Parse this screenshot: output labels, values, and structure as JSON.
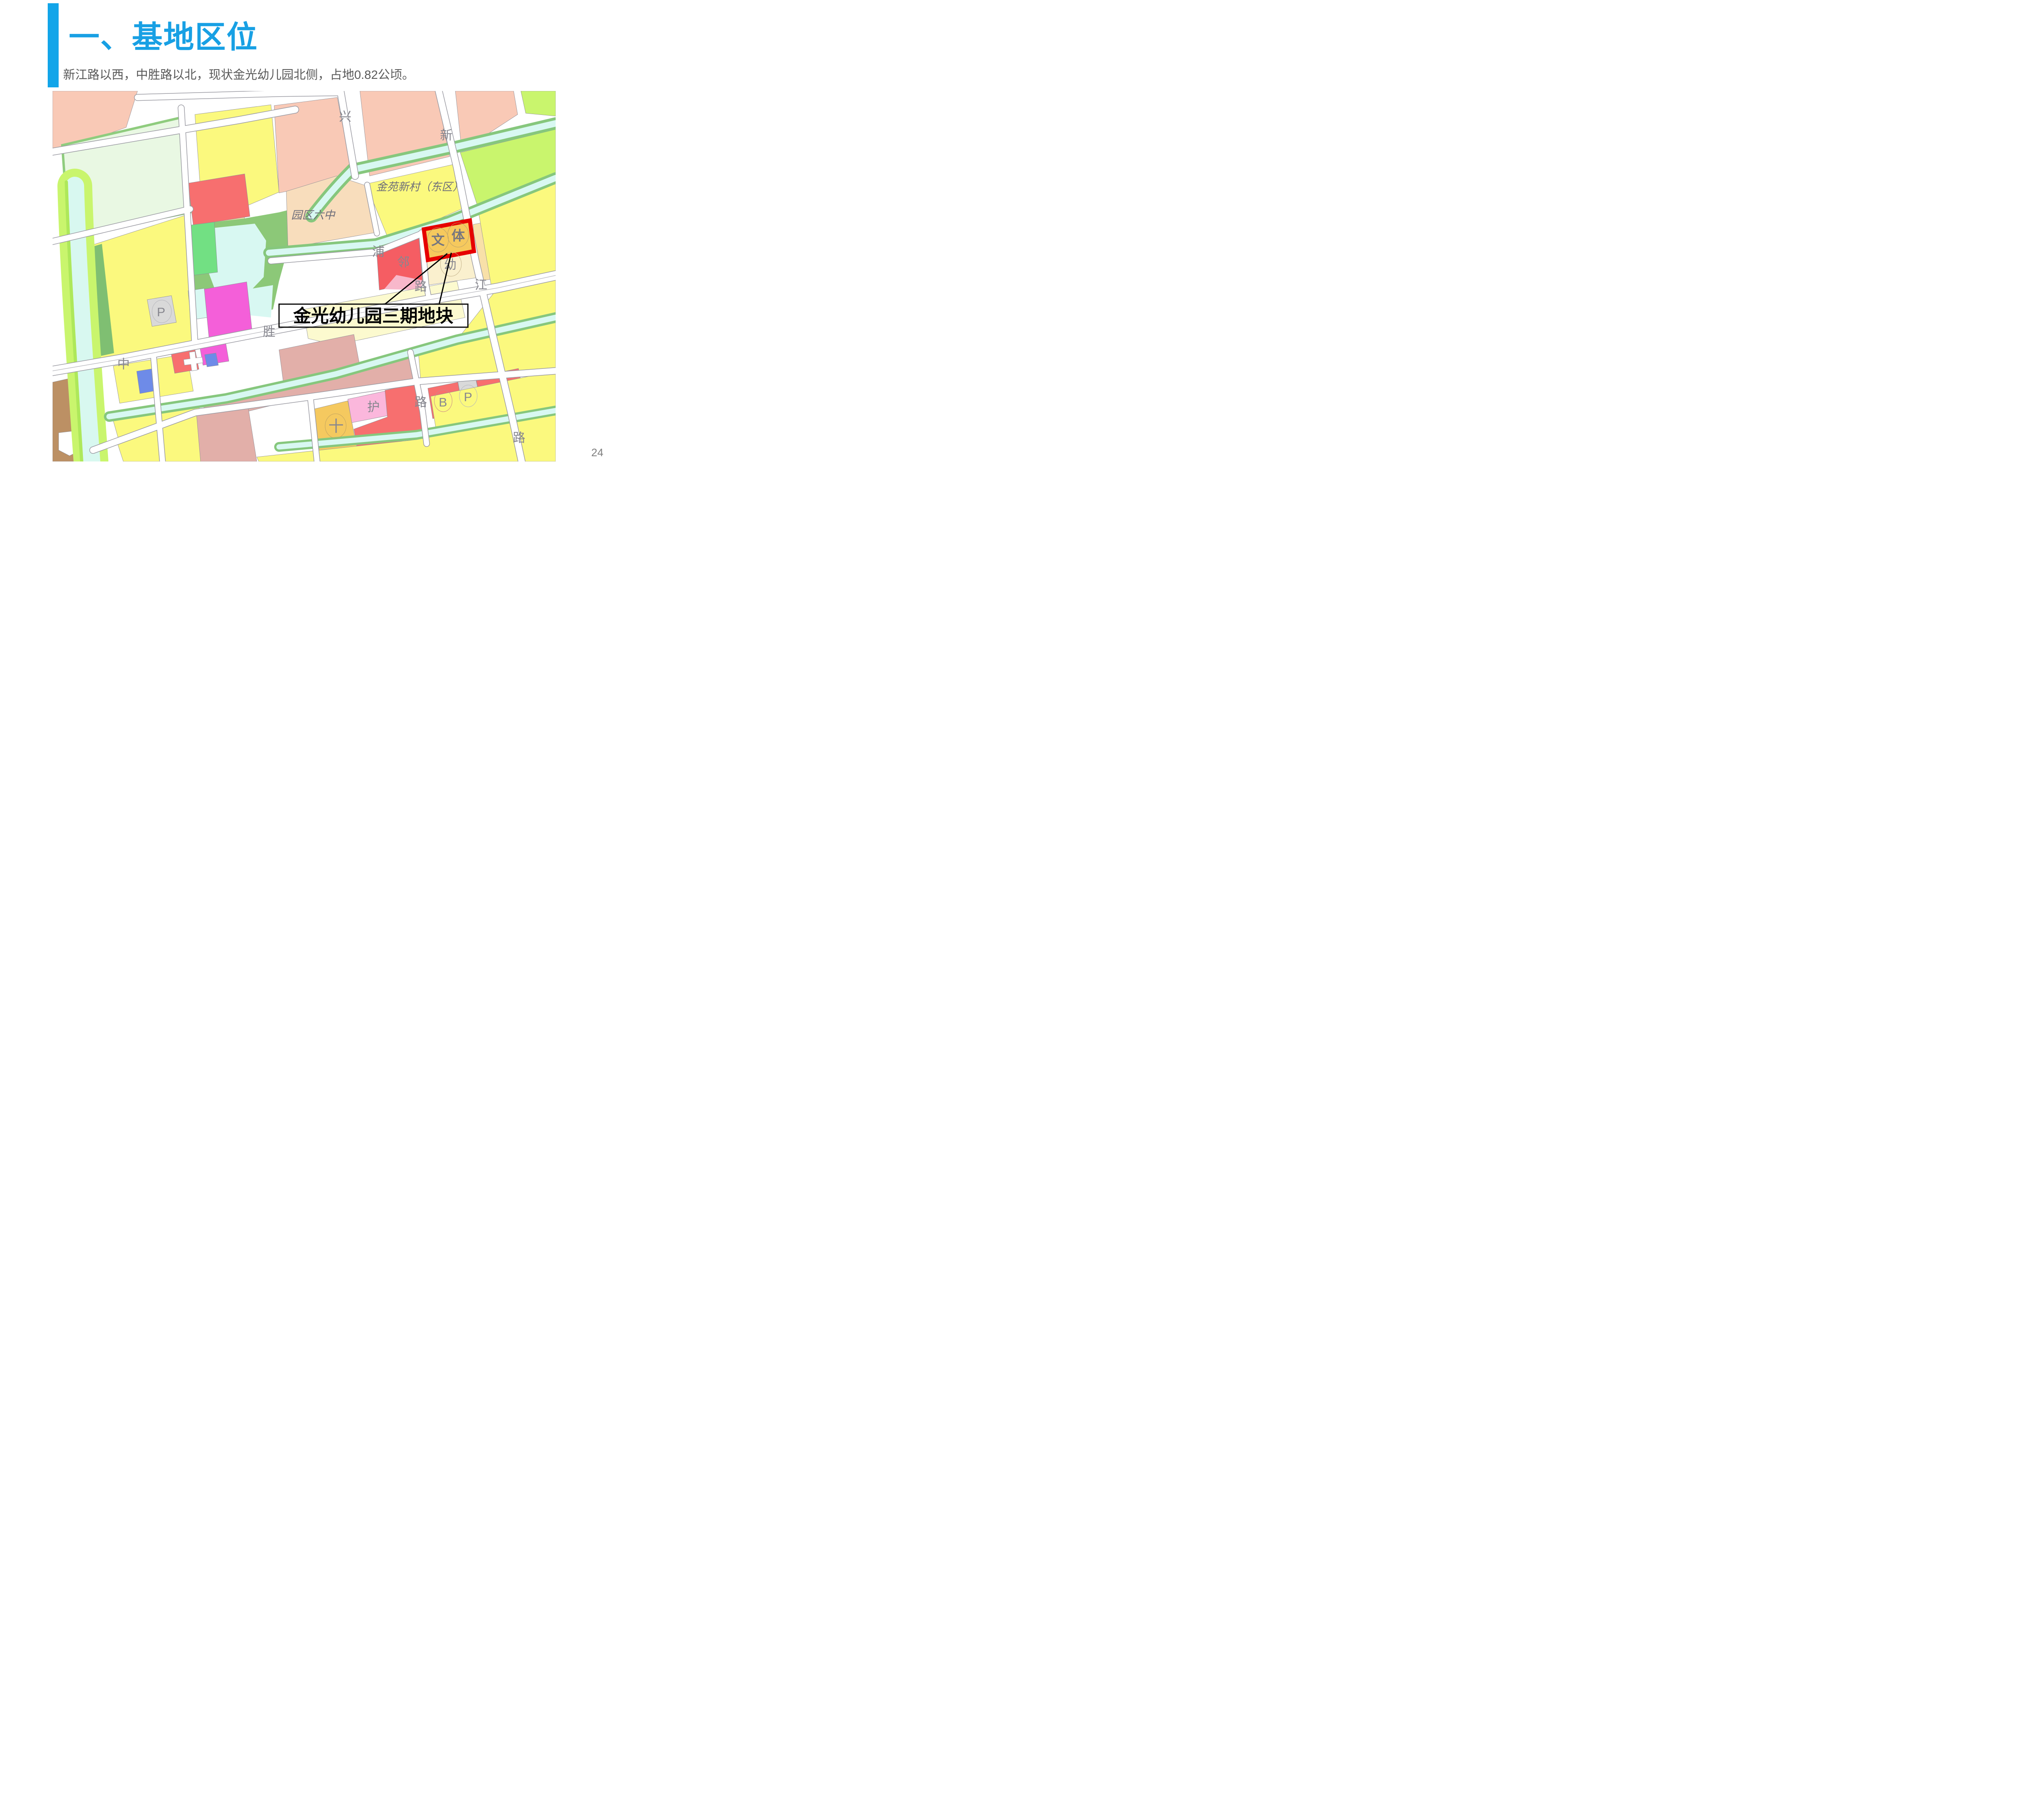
{
  "slide": {
    "title": "一、基地区位",
    "subtitle": "新江路以西，中胜路以北，现状金光幼儿园北侧，占地0.82公顷。",
    "page_number": "24",
    "accent_color": "#12a5e9",
    "title_color": "#18a0e4",
    "subtitle_color": "#595959"
  },
  "map": {
    "callout": {
      "text": "金光幼儿园三期地块"
    },
    "site": {
      "label_left": "文",
      "label_right": "体",
      "outline_color": "#e60000",
      "fill_color": "#f6c95d"
    },
    "labels": {
      "xing": "兴",
      "xin": "新",
      "jinyuan_estate": "金苑新村（东区）",
      "yuanqu_school": "园区六中",
      "pu": "浦",
      "lin": "邻",
      "you": "幼",
      "lu_mid": "路",
      "jiang": "江",
      "sheng": "胜",
      "zhong": "中",
      "p_left": "P",
      "hu": "护",
      "cross": "十",
      "lu_bottom": "路",
      "b": "B",
      "p_right": "P",
      "lu_right": "路"
    },
    "legend_colors": {
      "residential_yellow": "#fbf97e",
      "village_salmon": "#f9c9b6",
      "school_peach": "#f8ddbc",
      "public_red": "#f76f6f",
      "commercial_magenta": "#f45fd9",
      "blue_utility": "#6e8be8",
      "green_park": "#8cc878",
      "water_cyan": "#d8f8f2",
      "greenbelt_chartreuse": "#c9f56d",
      "parking_gray": "#d9d9d9",
      "brown": "#bc9064",
      "dusty_pink": "#e2afa9",
      "pink": "#fbb7dc",
      "cream": "#faf0ce",
      "road_white": "#ffffff"
    }
  }
}
